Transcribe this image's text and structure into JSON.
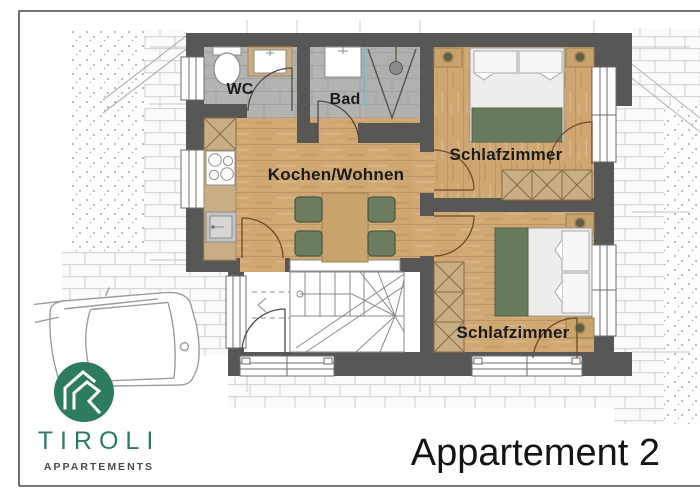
{
  "title": {
    "label": "Appartement 2"
  },
  "logo": {
    "brand": "TIROLI",
    "subtitle": "APPARTEMENTS",
    "icon": "house-in-circle-icon"
  },
  "plan": {
    "rooms": [
      {
        "label": "WC"
      },
      {
        "label": "Bad"
      },
      {
        "label": "Kochen/Wohnen"
      },
      {
        "label": "Schlafzimmer"
      },
      {
        "label": "Schlafzimmer"
      }
    ],
    "symbols": [
      "toilet-symbol",
      "washbasin-symbol",
      "shower-symbol",
      "stove-symbol",
      "kitchen-sink-symbol",
      "dining-table-symbol",
      "chair-symbol",
      "double-bed-symbol",
      "nightstand-lamp-symbol",
      "wardrobe-symbol",
      "staircase-symbol",
      "door-swing-symbol",
      "window-symbol",
      "car-outline"
    ]
  },
  "colors": {
    "wall": "#575756",
    "wood_floor": "#d0a873",
    "tile_floor": "#b3b3b1",
    "furniture_green": "#6b7c5f",
    "shower_glass": "#7bbcbe",
    "logo_green": "#2e7c5e",
    "text": "#1b1b1b"
  }
}
